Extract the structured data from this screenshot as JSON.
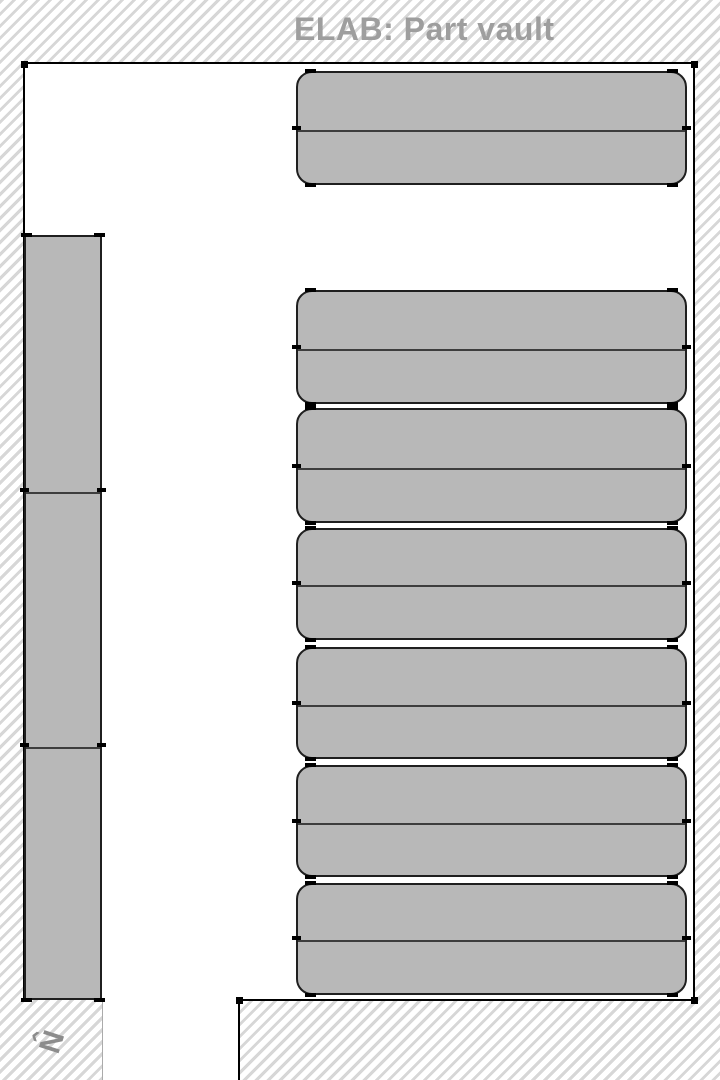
{
  "header": {
    "title": "ELAB: Part vault"
  },
  "compass": {
    "label": "N",
    "arrow": "‹",
    "points": "left"
  },
  "colors": {
    "floor": "#ffffff",
    "wall": "#000000",
    "hatch_stripe": "#d7d7d7",
    "shelf_fill": "#b8b8b8",
    "shelf_border": "#1f1f1f",
    "shelf_divider": "#3d3d3d",
    "title_text": "#9e9e9e",
    "compass_text": "#8c8c8c"
  },
  "floor_plan": {
    "room": {
      "x": 24,
      "y": 64,
      "width": 670,
      "height": 936
    },
    "doorway": {
      "x": 103,
      "y": 1000,
      "width": 136,
      "height": 80
    },
    "corner_markers": [
      [
        24,
        64
      ],
      [
        694,
        64
      ],
      [
        694,
        1000
      ],
      [
        239,
        1000
      ]
    ],
    "shelves": [
      {
        "id": "wall-rack-west",
        "x": 24,
        "y": 235,
        "width": 78,
        "height": 765,
        "rounded": false,
        "dividers": [
          255,
          510
        ]
      },
      {
        "id": "rack-row-1",
        "x": 296,
        "y": 71,
        "width": 391,
        "height": 114,
        "rounded": true,
        "dividers": [
          57
        ]
      },
      {
        "id": "rack-row-2",
        "x": 296,
        "y": 290,
        "width": 391,
        "height": 114,
        "rounded": true,
        "dividers": [
          57
        ]
      },
      {
        "id": "rack-row-3",
        "x": 296,
        "y": 408,
        "width": 391,
        "height": 115,
        "rounded": true,
        "dividers": [
          58
        ]
      },
      {
        "id": "rack-row-4",
        "x": 296,
        "y": 528,
        "width": 391,
        "height": 112,
        "rounded": true,
        "dividers": [
          55
        ]
      },
      {
        "id": "rack-row-5",
        "x": 296,
        "y": 647,
        "width": 391,
        "height": 112,
        "rounded": true,
        "dividers": [
          56
        ]
      },
      {
        "id": "rack-row-6",
        "x": 296,
        "y": 765,
        "width": 391,
        "height": 112,
        "rounded": true,
        "dividers": [
          56
        ]
      },
      {
        "id": "rack-row-7",
        "x": 296,
        "y": 883,
        "width": 391,
        "height": 112,
        "rounded": true,
        "dividers": [
          55
        ]
      }
    ]
  }
}
